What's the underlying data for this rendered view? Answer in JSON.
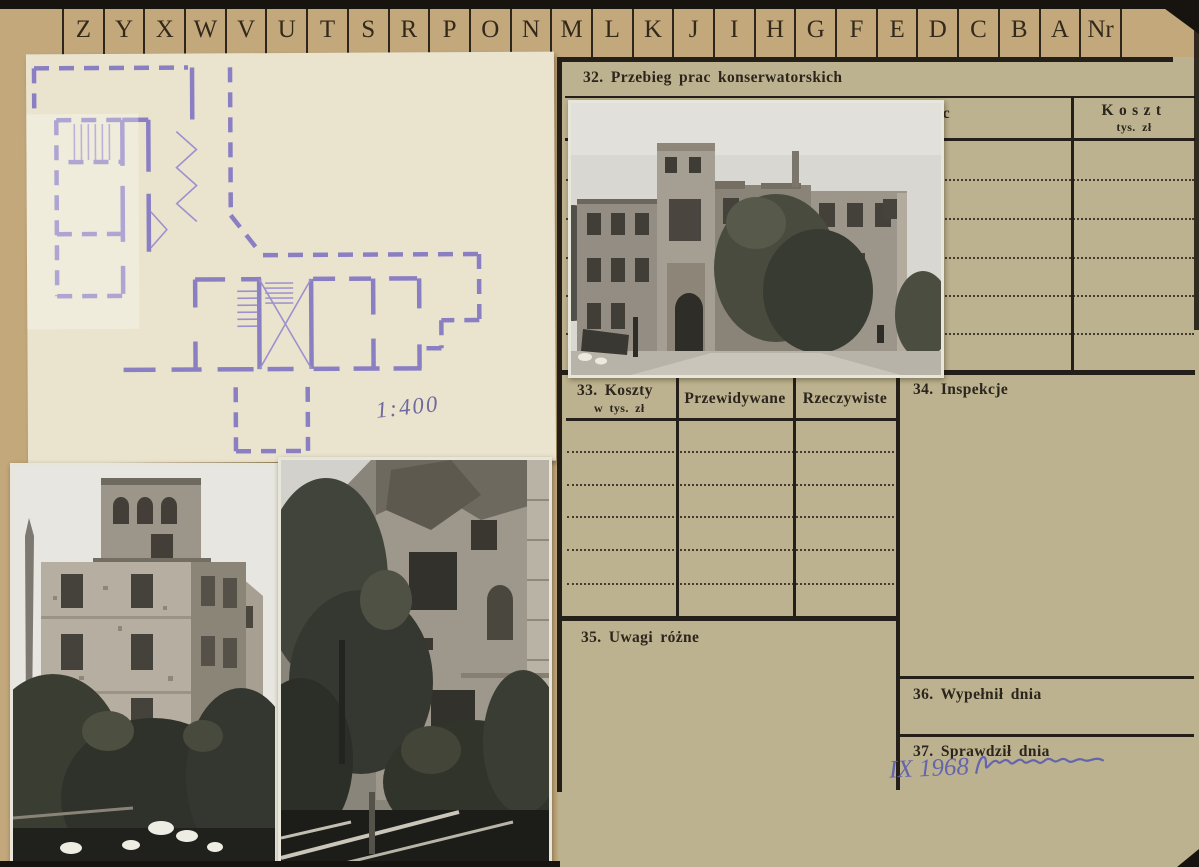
{
  "tab_strip": {
    "letters": [
      "Z",
      "Y",
      "X",
      "W",
      "V",
      "U",
      "T",
      "S",
      "R",
      "P",
      "O",
      "N",
      "M",
      "L",
      "K",
      "J",
      "I",
      "H",
      "G",
      "F",
      "E",
      "D",
      "C",
      "B",
      "A",
      "Nr"
    ]
  },
  "plan": {
    "scale_note": "1:400"
  },
  "form": {
    "s32": {
      "title": "32. Przebieg prac konserwatorskich",
      "col_fragment_label": "ac",
      "cost_label": "Koszt",
      "cost_unit": "tys. zł"
    },
    "s33": {
      "label": "33. Koszty",
      "unit": "w tys. zł",
      "col_expected": "Przewidywane",
      "col_actual": "Rzeczywiste"
    },
    "s34": {
      "label": "34. Inspekcje"
    },
    "s35": {
      "label": "35. Uwagi różne"
    },
    "s36": {
      "label": "36. Wypełnił dnia"
    },
    "s37": {
      "label": "37. Sprawdził dnia",
      "handwritten_date": "IX 1968"
    }
  },
  "colors": {
    "card_tan": "#c3a87c",
    "form_background": "#bdb28f",
    "plan_paper": "#eae4cf",
    "plan_ink": "#8b7fc3",
    "print_ink": "#2b251c",
    "handwriting_ink": "#6365ad"
  }
}
